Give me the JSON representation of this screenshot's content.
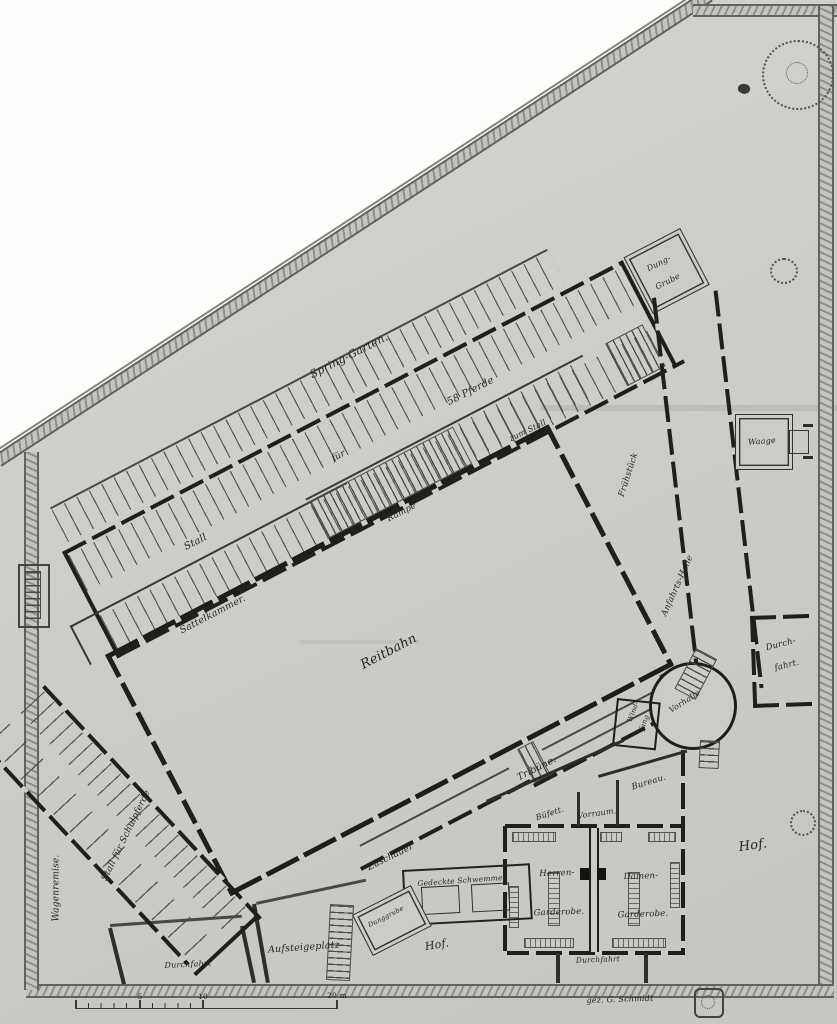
{
  "plan": {
    "grounds": {
      "spring_garten": "Spring-Garten.",
      "hof_right": "Hof.",
      "hof_bottom": "Hof.",
      "aufsteigeplatz": "Aufsteigeplatz"
    },
    "stable_wing": {
      "stall": "Stall",
      "fuer": "für",
      "horses": "58 Pferde",
      "dung_grube": [
        "Dung-",
        "Grube"
      ],
      "rampe": "Rampe",
      "zum_stall": "zum Stall",
      "sattelkammer": "Sattelkammer."
    },
    "arena": {
      "reitbahn": "Reitbahn",
      "tribuene": "Tribüne.",
      "zuschauer": "Zuschauer"
    },
    "right_wing": {
      "upper": "Frühstück",
      "lower": "Anfahrts-Halle",
      "waage": "Waage",
      "durchfahrt": [
        "Durch-",
        "fahrt."
      ]
    },
    "entrance": {
      "vorhalle": "Vorhalle",
      "windfang": [
        "Wind-",
        "fang"
      ]
    },
    "club_rooms": {
      "bureau": "Bureau.",
      "buefett": "Büfett.",
      "vorraum": "Vorraum.",
      "herren": [
        "Herren-",
        "Garderobe."
      ],
      "damen": [
        "Damen-",
        "Garderobe."
      ],
      "durchfahrt": "Durchfahrt"
    },
    "south_yard": {
      "schwemme": "Gedeckte Schwemme",
      "dunggrube": "Dunggrube",
      "durchfahrt_left": "Durchfahrt"
    },
    "left_wing": {
      "wagenremise": "Wagenremise.",
      "schulpferde": "Stall für Schulpferde"
    },
    "scale_bar": {
      "t5": "5",
      "t10": "10",
      "t20": "20 m"
    },
    "signature": "gez. G. Schmidt"
  },
  "colors": {
    "paper": "#cbcbc7",
    "ink": "#26261f",
    "wall": "#1f1f1c",
    "boundary": "#90908a",
    "white_cut": "#fdfdfc"
  }
}
